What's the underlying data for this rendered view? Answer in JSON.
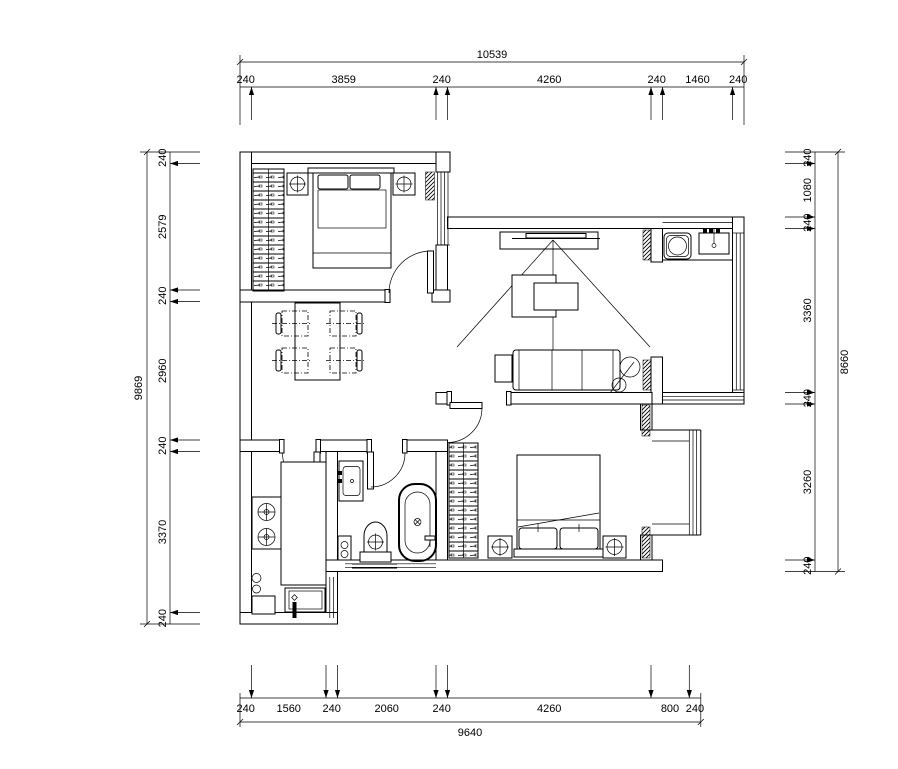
{
  "drawing": {
    "type": "apartment-floor-plan",
    "background": "#ffffff",
    "line_color": "#000000"
  },
  "dimensions": {
    "top": {
      "total": "10539",
      "segments": [
        "240",
        "3859",
        "240",
        "4260",
        "240",
        "1460",
        "240"
      ]
    },
    "bottom": {
      "total": "9640",
      "segments": [
        "240",
        "1560",
        "240",
        "2060",
        "240",
        "4260",
        "800",
        "240"
      ]
    },
    "left": {
      "total": "9869",
      "segments": [
        "240",
        "2579",
        "240",
        "2960",
        "240",
        "3370",
        "240"
      ]
    },
    "right": {
      "total": "8660",
      "segments": [
        "240",
        "1080",
        "240",
        "3360",
        "240",
        "3260",
        "240"
      ]
    }
  }
}
